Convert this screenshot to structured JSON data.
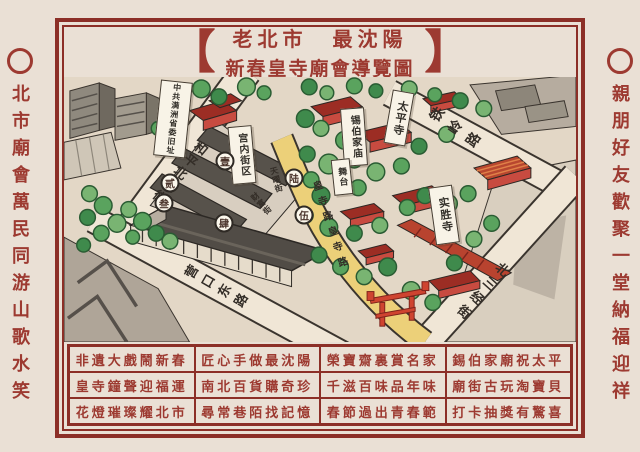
{
  "colors": {
    "maroon": "#9d3a31",
    "frame": "#8c2f27",
    "ink": "#332d27",
    "paper": "#eae0d5",
    "map_bg": "#e3d7c6",
    "road": "#f0e6d6",
    "royal_road": "#ecd079",
    "tree": "#5aa35e",
    "building_red": "#c84b40"
  },
  "title": {
    "bracket_left": "【",
    "bracket_right": "】",
    "line1": "老北市　最沈陽",
    "line2": "新春皇寺廟會導覽圖"
  },
  "side_left": {
    "text": "北市廟會萬民同游山歌水笑"
  },
  "side_right": {
    "text": "親朋好友歡聚一堂納福迎祥"
  },
  "map": {
    "streets": [
      {
        "name": "和平北大街",
        "x": 115,
        "y": 96,
        "rot": 40,
        "size": 13,
        "spacing": 3
      },
      {
        "name": "铁岭路",
        "x": 394,
        "y": 52,
        "rot": -55,
        "size": 14,
        "spacing": 8
      },
      {
        "name": "北三经街",
        "x": 417,
        "y": 215,
        "rot": 42,
        "size": 13,
        "spacing": 6
      },
      {
        "name": "营口东路",
        "x": 154,
        "y": 211,
        "rot": -60,
        "size": 13,
        "spacing": 6
      },
      {
        "name": "皇寺路皇寺路",
        "x": 265,
        "y": 150,
        "rot": -18,
        "size": 10,
        "spacing": 6
      },
      {
        "name": "天曜街",
        "x": 212,
        "y": 103,
        "rot": -15,
        "size": 8,
        "spacing": 1
      },
      {
        "name": "财富街",
        "x": 197,
        "y": 127,
        "rot": -42,
        "size": 8,
        "spacing": 1
      }
    ],
    "banners": [
      {
        "label": "中共满洲省委旧址",
        "x": 109,
        "y": 42,
        "w": 30,
        "h": 74,
        "rot": 6,
        "size": 8
      },
      {
        "label": "宫内街区",
        "x": 178,
        "y": 78,
        "w": 22,
        "h": 56,
        "rot": -5,
        "size": 10
      },
      {
        "label": "太平寺",
        "x": 335,
        "y": 41,
        "w": 20,
        "h": 52,
        "rot": 10,
        "size": 11
      },
      {
        "label": "锡伯家庙",
        "x": 290,
        "y": 60,
        "w": 22,
        "h": 56,
        "rot": -4,
        "size": 10
      },
      {
        "label": "实胜寺",
        "x": 380,
        "y": 138,
        "w": 22,
        "h": 56,
        "rot": -8,
        "size": 11
      },
      {
        "label": "舞台",
        "x": 278,
        "y": 100,
        "w": 17,
        "h": 34,
        "rot": -6,
        "size": 9
      }
    ],
    "markers": [
      {
        "label": "壹",
        "x": 161,
        "y": 84
      },
      {
        "label": "贰",
        "x": 106,
        "y": 106
      },
      {
        "label": "叁",
        "x": 100,
        "y": 126
      },
      {
        "label": "肆",
        "x": 160,
        "y": 146
      },
      {
        "label": "陆",
        "x": 230,
        "y": 101
      },
      {
        "label": "伍",
        "x": 240,
        "y": 138
      }
    ]
  },
  "legend": {
    "rows": [
      [
        "非遺大戲鬧新春",
        "匠心手做最沈陽",
        "榮寶齋裏賞名家",
        "錫伯家廟祝太平"
      ],
      [
        "皇寺鐘聲迎福運",
        "南北百貨購奇珍",
        "千滋百味品年味",
        "廟街古玩淘寶貝"
      ],
      [
        "花燈璀璨耀北市",
        "尋常巷陌找記憶",
        "春節過出青春範",
        "打卡抽獎有驚喜"
      ]
    ]
  }
}
